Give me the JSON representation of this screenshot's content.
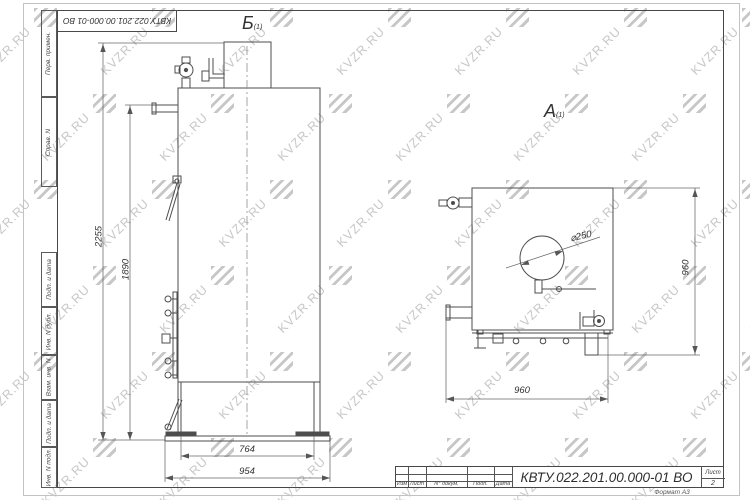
{
  "watermark": {
    "text": "KVZR.RU"
  },
  "frame": {
    "top_designation": "КВТУ.022.201.00.000-01 ВО",
    "left_labels": [
      "Перв. примен.",
      "Справ. N",
      "Подп. и дата",
      "Инв. N дубл.",
      "Взам. инв. N",
      "Подп. и дата",
      "Инв. N подл."
    ]
  },
  "views": {
    "front": {
      "label": "Б",
      "label_sub": "(1)",
      "dims": {
        "height_total": "2255",
        "height_to_pipe": "1890",
        "width_door": "764",
        "width_base": "954"
      }
    },
    "top": {
      "label": "А",
      "label_sub": "(1)",
      "dims": {
        "depth": "960",
        "width": "960",
        "flue_diameter": "⌀250"
      }
    }
  },
  "title_block": {
    "columns": [
      "Изм",
      "Лист",
      "N° докум.",
      "Подп.",
      "Дата"
    ],
    "designation": "КВТУ.022.201.00.000-01 ВО",
    "sheet_label": "Лист",
    "sheet_number": "2",
    "format_note": "Формат А3"
  },
  "colors": {
    "line": "#4d4d4d",
    "dim_line": "#666666",
    "watermark": "#c7c7c7"
  }
}
